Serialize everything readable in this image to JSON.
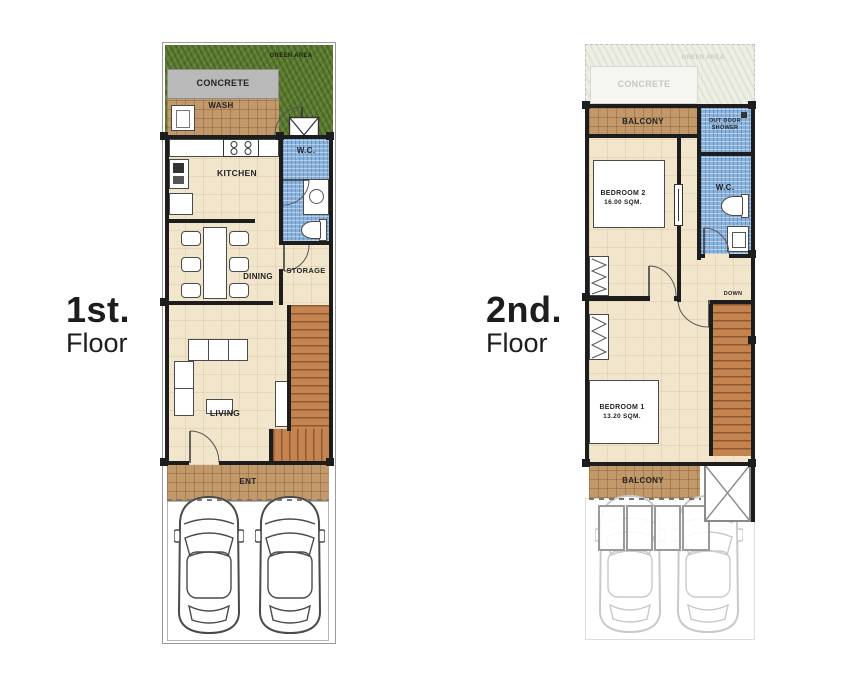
{
  "colors": {
    "wall": "#1d1d1d",
    "floor_beige": "#f1e5cc",
    "tile_brown": "#c2996a",
    "tile_blue": "#8ab3dc",
    "grass_green": "#5d7b33",
    "concrete_gray": "#b9b9b9",
    "stair_brown": "#c5834f",
    "ghost_gray": "#c9c9c9"
  },
  "floor1": {
    "title": "1st.",
    "subtitle": "Floor",
    "labels": {
      "green_area": "GREEN AREA",
      "concrete": "CONCRETE",
      "wash": "WASH",
      "kitchen": "KITCHEN",
      "wc": "W.C.",
      "dining": "DINING",
      "storage": "STORAGE",
      "living": "LIVING",
      "ent": "ENT"
    }
  },
  "floor2": {
    "title": "2nd.",
    "subtitle": "Floor",
    "labels": {
      "green_area_ghost": "GREEN AREA",
      "concrete_ghost": "CONCRETE",
      "balcony_top": "BALCONY",
      "outdoor_shower_line1": "OUT DOOR",
      "outdoor_shower_line2": "SHOWER",
      "wc": "W.C.",
      "bedroom2_name": "BEDROOM 2",
      "bedroom2_area": "16.00 SQM.",
      "down": "DOWN",
      "bedroom1_name": "BEDROOM 1",
      "bedroom1_area": "13.20 SQM.",
      "balcony_bottom": "BALCONY"
    }
  }
}
